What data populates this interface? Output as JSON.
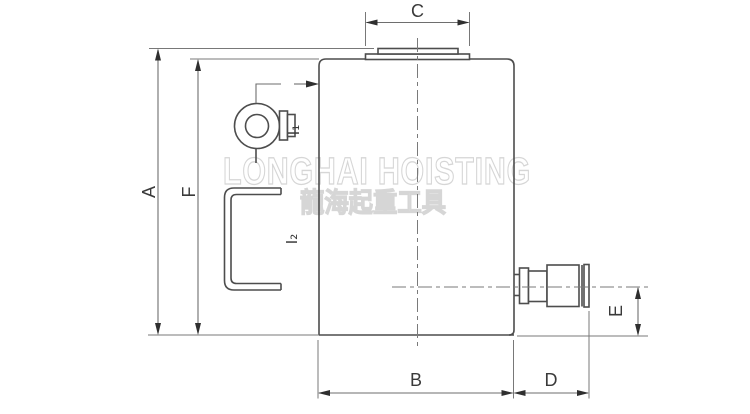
{
  "drawing": {
    "kind": "hydraulic-jack-outline-drawing",
    "labels": {
      "A": "A",
      "B": "B",
      "C": "C",
      "D": "D",
      "E": "E",
      "F": "F",
      "I1": "I₁",
      "I2": "I₂"
    },
    "watermark": {
      "line1": "LONGHAI HOISTING",
      "line2": "龍海起重工具"
    },
    "colors": {
      "background": "#ffffff",
      "part_line": "#4d4d4d",
      "dimension_line": "#6e6e6e",
      "label_text": "#3a3a3a",
      "watermark_outline": "#d6d6d6"
    }
  }
}
